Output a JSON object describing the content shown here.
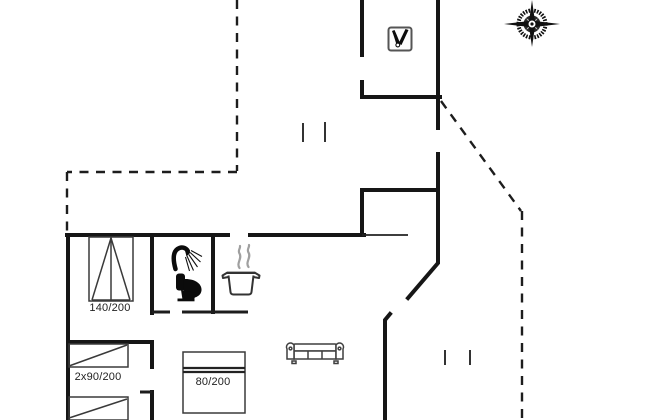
{
  "floorplan": {
    "bed_labels": {
      "double_bed": "140/200",
      "twin_beds": "2x90/200",
      "single_bed": "80/200"
    },
    "icons": [
      "compass-rose-icon",
      "wood-stove-icon",
      "shower-icon",
      "toilet-icon",
      "cooking-pot-icon",
      "sofa-icon",
      "double-bed-icon",
      "twin-bed-icon",
      "single-bed-icon"
    ],
    "colors": {
      "walls": "#161616",
      "dashed_boundary": "#1d1d1d",
      "furniture_outline": "#3a3a3a",
      "steam": "#a0a0a0",
      "label_text": "#222222",
      "background": "#ffffff"
    }
  }
}
